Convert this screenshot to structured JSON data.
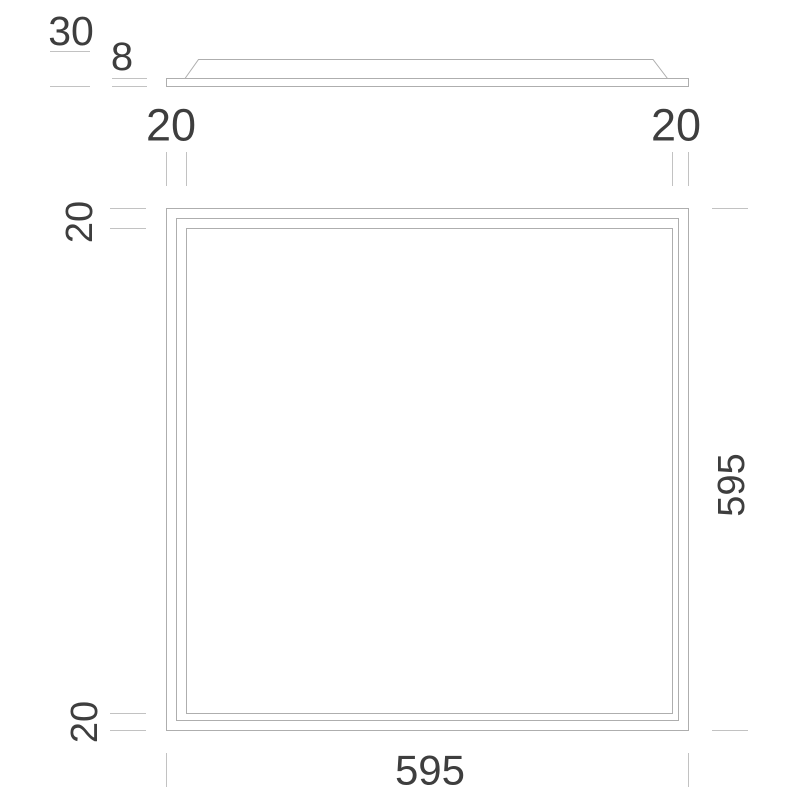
{
  "colors": {
    "background": "#ffffff",
    "drawing_line": "#aeaeae",
    "tick_line": "#c2c2c2",
    "text": "#3e3e3e"
  },
  "views": {
    "side_profile": "panel side profile",
    "front": "panel front face"
  },
  "dimensions": {
    "profile_height_mm": "30",
    "profile_thickness_mm": "8",
    "frame_top_left_mm": "20",
    "frame_top_right_mm": "20",
    "frame_left_top_mm": "20",
    "frame_left_bottom_mm": "20",
    "panel_height_mm": "595",
    "panel_width_mm": "595"
  }
}
